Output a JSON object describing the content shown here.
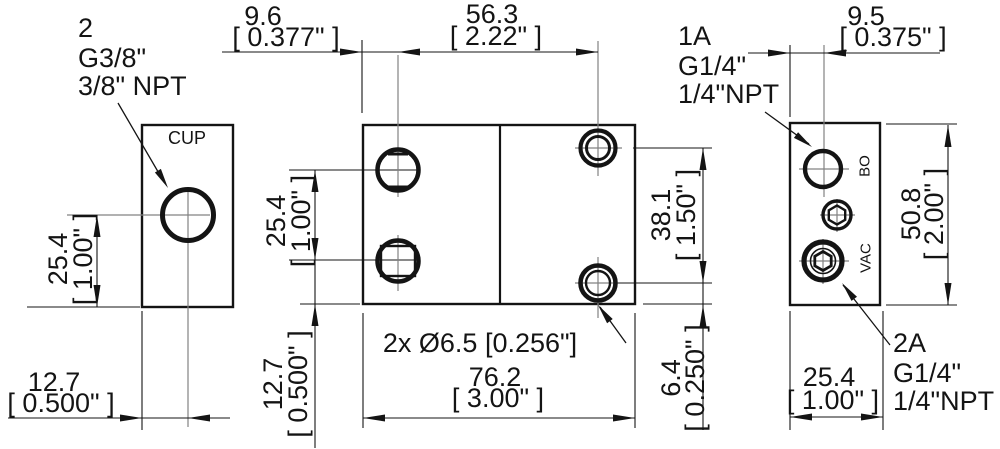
{
  "drawing": {
    "title": "pump-block-3-view-dimension-drawing",
    "colors": {
      "line": "#141414",
      "centerline": "#828282",
      "background": "#ffffff"
    },
    "views": {
      "left": {
        "port_label": "CUP"
      },
      "right": {
        "top_port_label": "BO",
        "bottom_port_label": "VAC"
      }
    },
    "callouts": {
      "cup_port": {
        "l1": "2",
        "l2": "G3/8\"",
        "l3": "3/8\" NPT"
      },
      "bo_port": {
        "l1": "1A",
        "l2": "G1/4\"",
        "l3": "1/4\"NPT"
      },
      "vac_port": {
        "l1": "2A",
        "l2": "G1/4\"",
        "l3": "1/4\"NPT"
      },
      "hole_note": "2x Ø6.5 [0.256\"]"
    },
    "dims": {
      "w96": {
        "mm": "9.6",
        "in": "[ 0.377\" ]"
      },
      "w563": {
        "mm": "56.3",
        "in": "[ 2.22\" ]"
      },
      "w95": {
        "mm": "9.5",
        "in": "[ 0.375\" ]"
      },
      "h254L": {
        "mm": "25.4",
        "in": "[ 1.00\" ]"
      },
      "w127L": {
        "mm": "12.7",
        "in": "[ 0.500\" ]"
      },
      "h254M": {
        "mm": "25.4",
        "in": "[ 1.00\" ]"
      },
      "h127M": {
        "mm": "12.7",
        "in": "[ 0.500\" ]"
      },
      "w762": {
        "mm": "76.2",
        "in": "[ 3.00\" ]"
      },
      "h381": {
        "mm": "38.1",
        "in": "[ 1.50\" ]"
      },
      "h64": {
        "mm": "6.4",
        "in": "[ 0.250\" ]"
      },
      "h508": {
        "mm": "50.8",
        "in": "[ 2.00\" ]"
      },
      "w254R": {
        "mm": "25.4",
        "in": "[ 1.00\" ]"
      }
    }
  }
}
